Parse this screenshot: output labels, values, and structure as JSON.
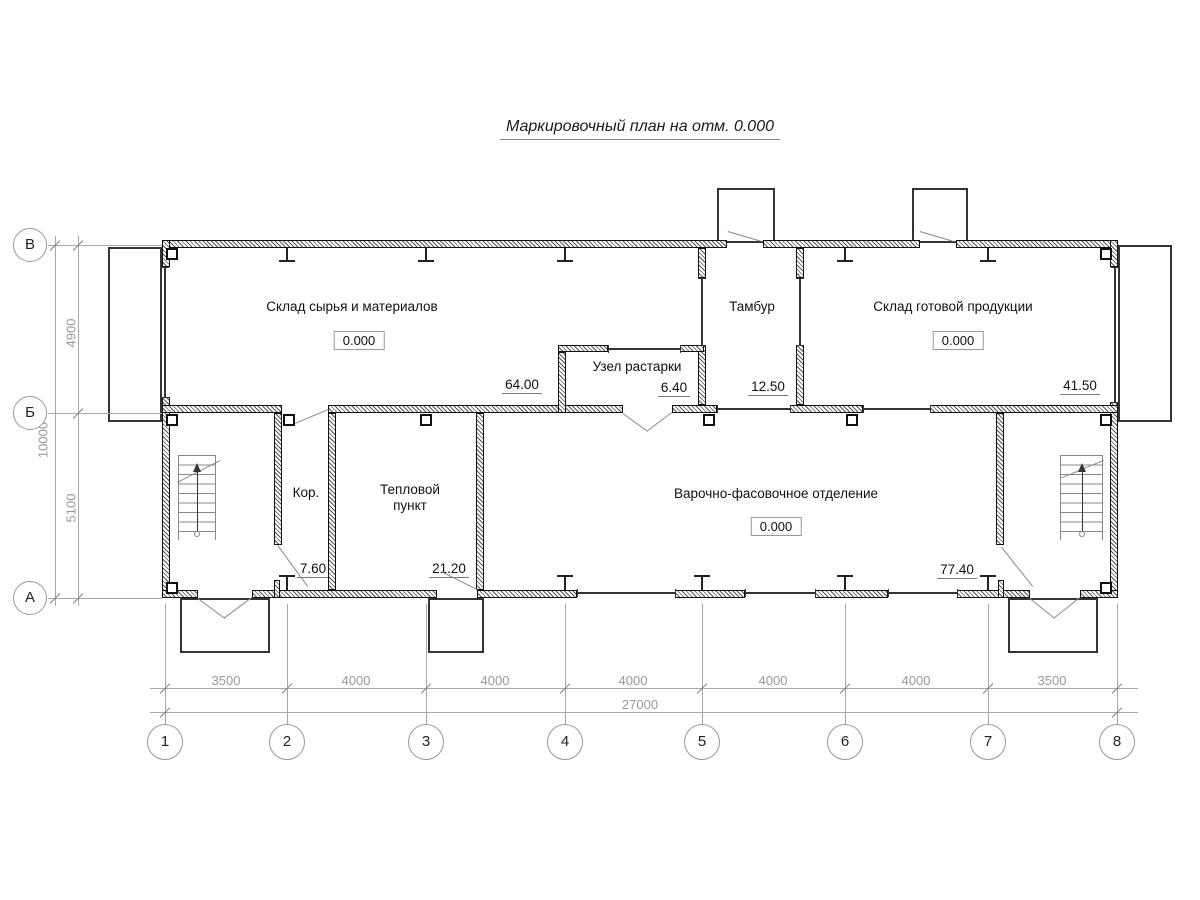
{
  "title": "Маркировочный план на отм. 0.000",
  "rooms": {
    "raw_materials": {
      "name": "Склад сырья и материалов",
      "elevation": "0.000",
      "area": "64.00"
    },
    "tambour": {
      "name": "Тамбур",
      "area": "12.50"
    },
    "finished_goods": {
      "name": "Склад готовой продукции",
      "elevation": "0.000",
      "area": "41.50"
    },
    "unpacking": {
      "name": "Узел растарки",
      "area": "6.40"
    },
    "corridor": {
      "name": "Кор.",
      "area": "7.60"
    },
    "heating_unit": {
      "name": "Тепловой пункт",
      "area": "21.20"
    },
    "cooking_packing": {
      "name": "Варочно-фасовочное отделение",
      "elevation": "0.000",
      "area": "77.40"
    }
  },
  "axes": {
    "columns": [
      "1",
      "2",
      "3",
      "4",
      "5",
      "6",
      "7",
      "8"
    ],
    "rows": [
      "В",
      "Б",
      "А"
    ]
  },
  "dimensions": {
    "spans": [
      "3500",
      "4000",
      "4000",
      "4000",
      "4000",
      "4000",
      "3500"
    ],
    "total_width": "27000",
    "row_spans": [
      "4900",
      "5100"
    ],
    "total_height": "10000"
  }
}
